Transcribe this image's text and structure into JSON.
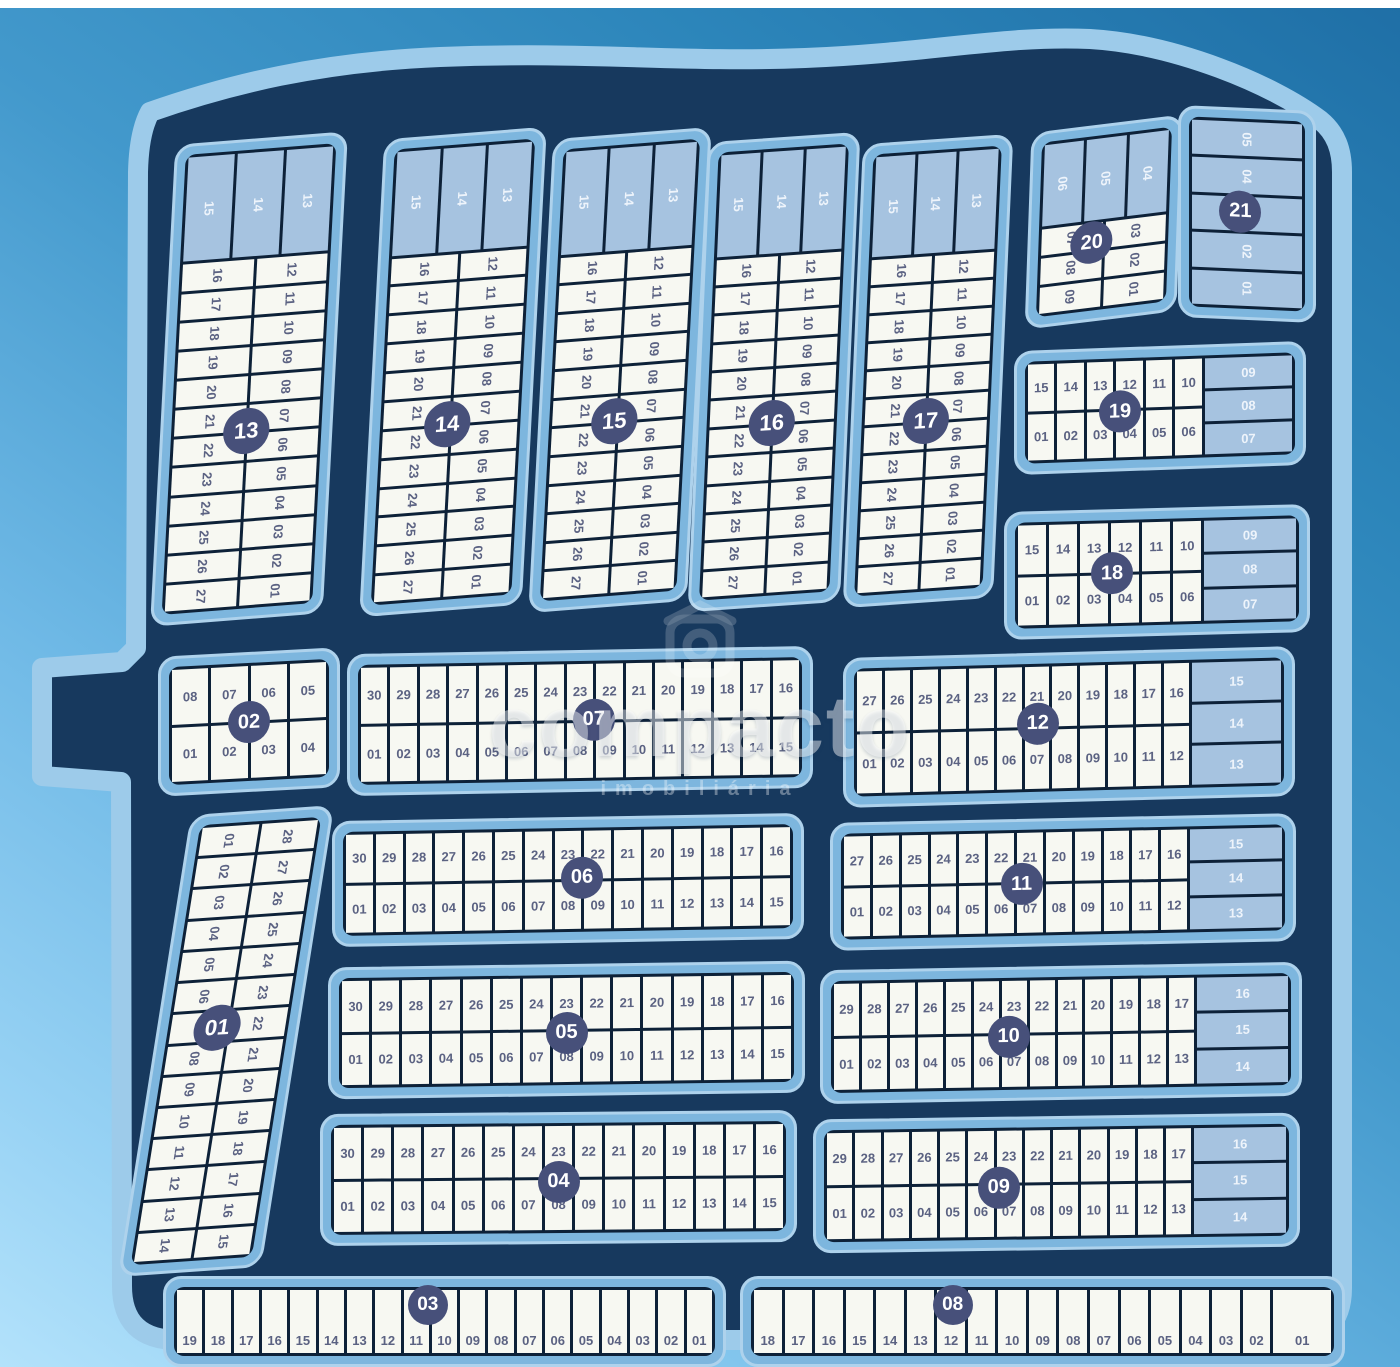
{
  "title": "Loteamento - mapa de quadras e lotes",
  "watermark": {
    "icon": "house-logo-icon",
    "brand": "compacto",
    "subtext": "imobiliária"
  },
  "colors": {
    "background_dark": "#2c85ba",
    "background_light": "#b3e2fb",
    "plat_navy": "#17395e",
    "sidewalk": "#9dcbea",
    "block_blue": "#7db6de",
    "block_rim": "#aed2ec",
    "lot_white": "#f7f8f2",
    "lot_light_blue": "#a6c3e0",
    "lot_line": "#0d2138",
    "lot_number_text": "#5b6282",
    "badge_navy": "#47507a",
    "badge_text": "#ffffff"
  },
  "blocks": [
    {
      "id": "13",
      "type": "tower",
      "x": 163,
      "y": 138,
      "w": 172,
      "h": 482,
      "tf": "skewX(-3deg) skewY(-4.5deg)",
      "topH": 0.23,
      "top": [
        "15",
        "14",
        "13"
      ],
      "left": [
        "16",
        "17",
        "18",
        "19",
        "20",
        "21",
        "22",
        "23",
        "24",
        "25",
        "26",
        "27"
      ],
      "right": [
        "12",
        "11",
        "10",
        "09",
        "08",
        "07",
        "06",
        "05",
        "04",
        "03",
        "02",
        "01"
      ],
      "bx": 50,
      "by": 61
    },
    {
      "id": "14",
      "type": "tower",
      "x": 372,
      "y": 133,
      "w": 162,
      "h": 478,
      "tf": "skewX(-3deg) skewY(-4.5deg)",
      "topH": 0.23,
      "top": [
        "15",
        "14",
        "13"
      ],
      "left": [
        "16",
        "17",
        "18",
        "19",
        "20",
        "21",
        "22",
        "23",
        "24",
        "25",
        "26",
        "27"
      ],
      "right": [
        "12",
        "11",
        "10",
        "09",
        "08",
        "07",
        "06",
        "05",
        "04",
        "03",
        "02",
        "01"
      ],
      "bx": 48,
      "by": 61
    },
    {
      "id": "15",
      "type": "tower",
      "x": 541,
      "y": 133,
      "w": 158,
      "h": 474,
      "tf": "skewX(-3deg) skewY(-4.5deg)",
      "topH": 0.23,
      "top": [
        "15",
        "14",
        "13"
      ],
      "left": [
        "16",
        "17",
        "18",
        "19",
        "20",
        "21",
        "22",
        "23",
        "24",
        "25",
        "26",
        "27"
      ],
      "right": [
        "12",
        "11",
        "10",
        "09",
        "08",
        "07",
        "06",
        "05",
        "04",
        "03",
        "02",
        "01"
      ],
      "bx": 48,
      "by": 61
    },
    {
      "id": "16",
      "type": "tower",
      "x": 698,
      "y": 137,
      "w": 152,
      "h": 470,
      "tf": "skewX(-2.5deg) skewY(-4deg)",
      "topH": 0.23,
      "top": [
        "15",
        "14",
        "13"
      ],
      "left": [
        "16",
        "17",
        "18",
        "19",
        "20",
        "21",
        "22",
        "23",
        "24",
        "25",
        "26",
        "27"
      ],
      "right": [
        "12",
        "11",
        "10",
        "09",
        "08",
        "07",
        "06",
        "05",
        "04",
        "03",
        "02",
        "01"
      ],
      "bx": 50,
      "by": 61
    },
    {
      "id": "17",
      "type": "tower",
      "x": 853,
      "y": 139,
      "w": 150,
      "h": 464,
      "tf": "skewX(-2.5deg) skewY(-4deg)",
      "topH": 0.23,
      "top": [
        "15",
        "14",
        "13"
      ],
      "left": [
        "16",
        "17",
        "18",
        "19",
        "20",
        "21",
        "22",
        "23",
        "24",
        "25",
        "26",
        "27"
      ],
      "right": [
        "12",
        "11",
        "10",
        "09",
        "08",
        "07",
        "06",
        "05",
        "04",
        "03",
        "02",
        "01"
      ],
      "bx": 50,
      "by": 61
    },
    {
      "id": "20",
      "type": "tower",
      "x": 1028,
      "y": 124,
      "w": 152,
      "h": 196,
      "tf": "skewY(-7deg) skewX(-2deg)",
      "topH": 0.48,
      "top": [
        "06",
        "05",
        "04"
      ],
      "left": [
        "07",
        "08",
        "09"
      ],
      "right": [
        "03",
        "02",
        "01"
      ],
      "bx": 42,
      "by": 60,
      "bsize": 42
    },
    {
      "id": "21",
      "type": "stack",
      "x": 1178,
      "y": 108,
      "w": 138,
      "h": 212,
      "tf": "skewY(2.5deg)",
      "lots": [
        "05",
        "04",
        "03",
        "02",
        "01"
      ],
      "bx": 45,
      "by": 49,
      "bsize": 42
    },
    {
      "id": "19",
      "type": "slab",
      "x": 1014,
      "y": 346,
      "w": 292,
      "h": 124,
      "tf": "skewY(-2deg)",
      "top": [
        "15",
        "14",
        "13",
        "12",
        "11",
        "10"
      ],
      "bottom": [
        "01",
        "02",
        "03",
        "04",
        "05",
        "06"
      ],
      "side": [
        "09",
        "08",
        "07"
      ],
      "sideW": 0.33,
      "bx": 36,
      "by": 52,
      "bsize": 42
    },
    {
      "id": "18",
      "type": "slab",
      "x": 1004,
      "y": 508,
      "w": 306,
      "h": 128,
      "tf": "skewY(-1.5deg)",
      "top": [
        "15",
        "14",
        "13",
        "12",
        "11",
        "10"
      ],
      "bottom": [
        "01",
        "02",
        "03",
        "04",
        "05",
        "06"
      ],
      "side": [
        "09",
        "08",
        "07"
      ],
      "sideW": 0.33,
      "bx": 35,
      "by": 50,
      "bsize": 42
    },
    {
      "id": "02",
      "type": "slab",
      "x": 158,
      "y": 652,
      "w": 182,
      "h": 140,
      "tf": "skewY(-3deg)",
      "top": [
        "08",
        "07",
        "06",
        "05"
      ],
      "bottom": [
        "01",
        "02",
        "03",
        "04"
      ],
      "bx": 50,
      "by": 50,
      "bsize": 42
    },
    {
      "id": "07",
      "type": "slab",
      "x": 347,
      "y": 650,
      "w": 466,
      "h": 142,
      "tf": "skewY(-1deg)",
      "top": [
        "30",
        "29",
        "28",
        "27",
        "26",
        "25",
        "24",
        "23",
        "22",
        "21",
        "20",
        "19",
        "18",
        "17",
        "16"
      ],
      "bottom": [
        "01",
        "02",
        "03",
        "04",
        "05",
        "06",
        "07",
        "08",
        "09",
        "10",
        "11",
        "12",
        "13",
        "14",
        "15"
      ],
      "bx": 53,
      "by": 49,
      "bsize": 42
    },
    {
      "id": "12",
      "type": "slab",
      "x": 843,
      "y": 652,
      "w": 452,
      "h": 150,
      "tf": "skewY(-1.5deg)",
      "top": [
        "27",
        "26",
        "25",
        "24",
        "23",
        "22",
        "21",
        "20",
        "19",
        "18",
        "17",
        "16"
      ],
      "bottom": [
        "01",
        "02",
        "03",
        "04",
        "05",
        "06",
        "07",
        "08",
        "09",
        "10",
        "11",
        "12"
      ],
      "side": [
        "15",
        "14",
        "13"
      ],
      "sideW": 0.21,
      "bx": 43,
      "by": 47,
      "bsize": 42
    },
    {
      "id": "01",
      "type": "twincol",
      "x": 155,
      "y": 810,
      "w": 142,
      "h": 462,
      "tf": "skewX(-9deg) skewY(-4deg)",
      "left": [
        "01",
        "02",
        "03",
        "04",
        "05",
        "06",
        "07",
        "08",
        "09",
        "10",
        "11",
        "12",
        "13",
        "14"
      ],
      "right": [
        "28",
        "27",
        "26",
        "25",
        "24",
        "23",
        "22",
        "21",
        "20",
        "19",
        "18",
        "17",
        "16",
        "15"
      ],
      "bx": 42,
      "by": 47
    },
    {
      "id": "06",
      "type": "slab",
      "x": 332,
      "y": 817,
      "w": 472,
      "h": 126,
      "tf": "skewY(-1deg)",
      "top": [
        "30",
        "29",
        "28",
        "27",
        "26",
        "25",
        "24",
        "23",
        "22",
        "21",
        "20",
        "19",
        "18",
        "17",
        "16"
      ],
      "bottom": [
        "01",
        "02",
        "03",
        "04",
        "05",
        "06",
        "07",
        "08",
        "09",
        "10",
        "11",
        "12",
        "13",
        "14",
        "15"
      ],
      "bx": 53,
      "by": 48,
      "bsize": 42
    },
    {
      "id": "11",
      "type": "slab",
      "x": 830,
      "y": 818,
      "w": 466,
      "h": 128,
      "tf": "skewY(-1.2deg)",
      "top": [
        "27",
        "26",
        "25",
        "24",
        "23",
        "22",
        "21",
        "20",
        "19",
        "18",
        "17",
        "16"
      ],
      "bottom": [
        "01",
        "02",
        "03",
        "04",
        "05",
        "06",
        "07",
        "08",
        "09",
        "10",
        "11",
        "12"
      ],
      "side": [
        "15",
        "14",
        "13"
      ],
      "sideW": 0.21,
      "bx": 41,
      "by": 51,
      "bsize": 42
    },
    {
      "id": "05",
      "type": "slab",
      "x": 328,
      "y": 964,
      "w": 477,
      "h": 132,
      "tf": "skewY(-0.8deg)",
      "top": [
        "30",
        "29",
        "28",
        "27",
        "26",
        "25",
        "24",
        "23",
        "22",
        "21",
        "20",
        "19",
        "18",
        "17",
        "16"
      ],
      "bottom": [
        "01",
        "02",
        "03",
        "04",
        "05",
        "06",
        "07",
        "08",
        "09",
        "10",
        "11",
        "12",
        "13",
        "14",
        "15"
      ],
      "bx": 50,
      "by": 52,
      "bsize": 42
    },
    {
      "id": "10",
      "type": "slab",
      "x": 820,
      "y": 966,
      "w": 482,
      "h": 134,
      "tf": "skewY(-1deg)",
      "top": [
        "29",
        "28",
        "27",
        "26",
        "25",
        "24",
        "23",
        "22",
        "21",
        "20",
        "19",
        "18",
        "17"
      ],
      "bottom": [
        "01",
        "02",
        "03",
        "04",
        "05",
        "06",
        "07",
        "08",
        "09",
        "10",
        "11",
        "12",
        "13"
      ],
      "side": [
        "16",
        "15",
        "14"
      ],
      "sideW": 0.2,
      "bx": 39,
      "by": 52,
      "bsize": 42
    },
    {
      "id": "04",
      "type": "slab",
      "x": 320,
      "y": 1112,
      "w": 477,
      "h": 132,
      "tf": "skewY(-0.5deg)",
      "top": [
        "30",
        "29",
        "28",
        "27",
        "26",
        "25",
        "24",
        "23",
        "22",
        "21",
        "20",
        "19",
        "18",
        "17",
        "16"
      ],
      "bottom": [
        "01",
        "02",
        "03",
        "04",
        "05",
        "06",
        "07",
        "08",
        "09",
        "10",
        "11",
        "12",
        "13",
        "14",
        "15"
      ],
      "bx": 50,
      "by": 53,
      "bsize": 42
    },
    {
      "id": "09",
      "type": "slab",
      "x": 813,
      "y": 1116,
      "w": 487,
      "h": 134,
      "tf": "skewY(-0.8deg)",
      "top": [
        "29",
        "28",
        "27",
        "26",
        "25",
        "24",
        "23",
        "22",
        "21",
        "20",
        "19",
        "18",
        "17"
      ],
      "bottom": [
        "01",
        "02",
        "03",
        "04",
        "05",
        "06",
        "07",
        "08",
        "09",
        "10",
        "11",
        "12",
        "13"
      ],
      "side": [
        "16",
        "15",
        "14"
      ],
      "sideW": 0.2,
      "bx": 38,
      "by": 53,
      "bsize": 42
    },
    {
      "id": "03",
      "type": "bar",
      "x": 163,
      "y": 1276,
      "w": 563,
      "h": 91,
      "lots": [
        "19",
        "18",
        "17",
        "16",
        "15",
        "14",
        "13",
        "12",
        "11",
        "10",
        "09",
        "08",
        "07",
        "06",
        "05",
        "04",
        "03",
        "02",
        "01"
      ],
      "bx": 47,
      "by": 30,
      "bsize": 40
    },
    {
      "id": "08",
      "type": "bar",
      "x": 740,
      "y": 1276,
      "w": 605,
      "h": 91,
      "lastWide": true,
      "lots": [
        "18",
        "17",
        "16",
        "15",
        "14",
        "13",
        "12",
        "11",
        "10",
        "09",
        "08",
        "07",
        "06",
        "05",
        "04",
        "03",
        "02",
        "01"
      ],
      "bx": 35,
      "by": 30,
      "bsize": 40
    }
  ]
}
